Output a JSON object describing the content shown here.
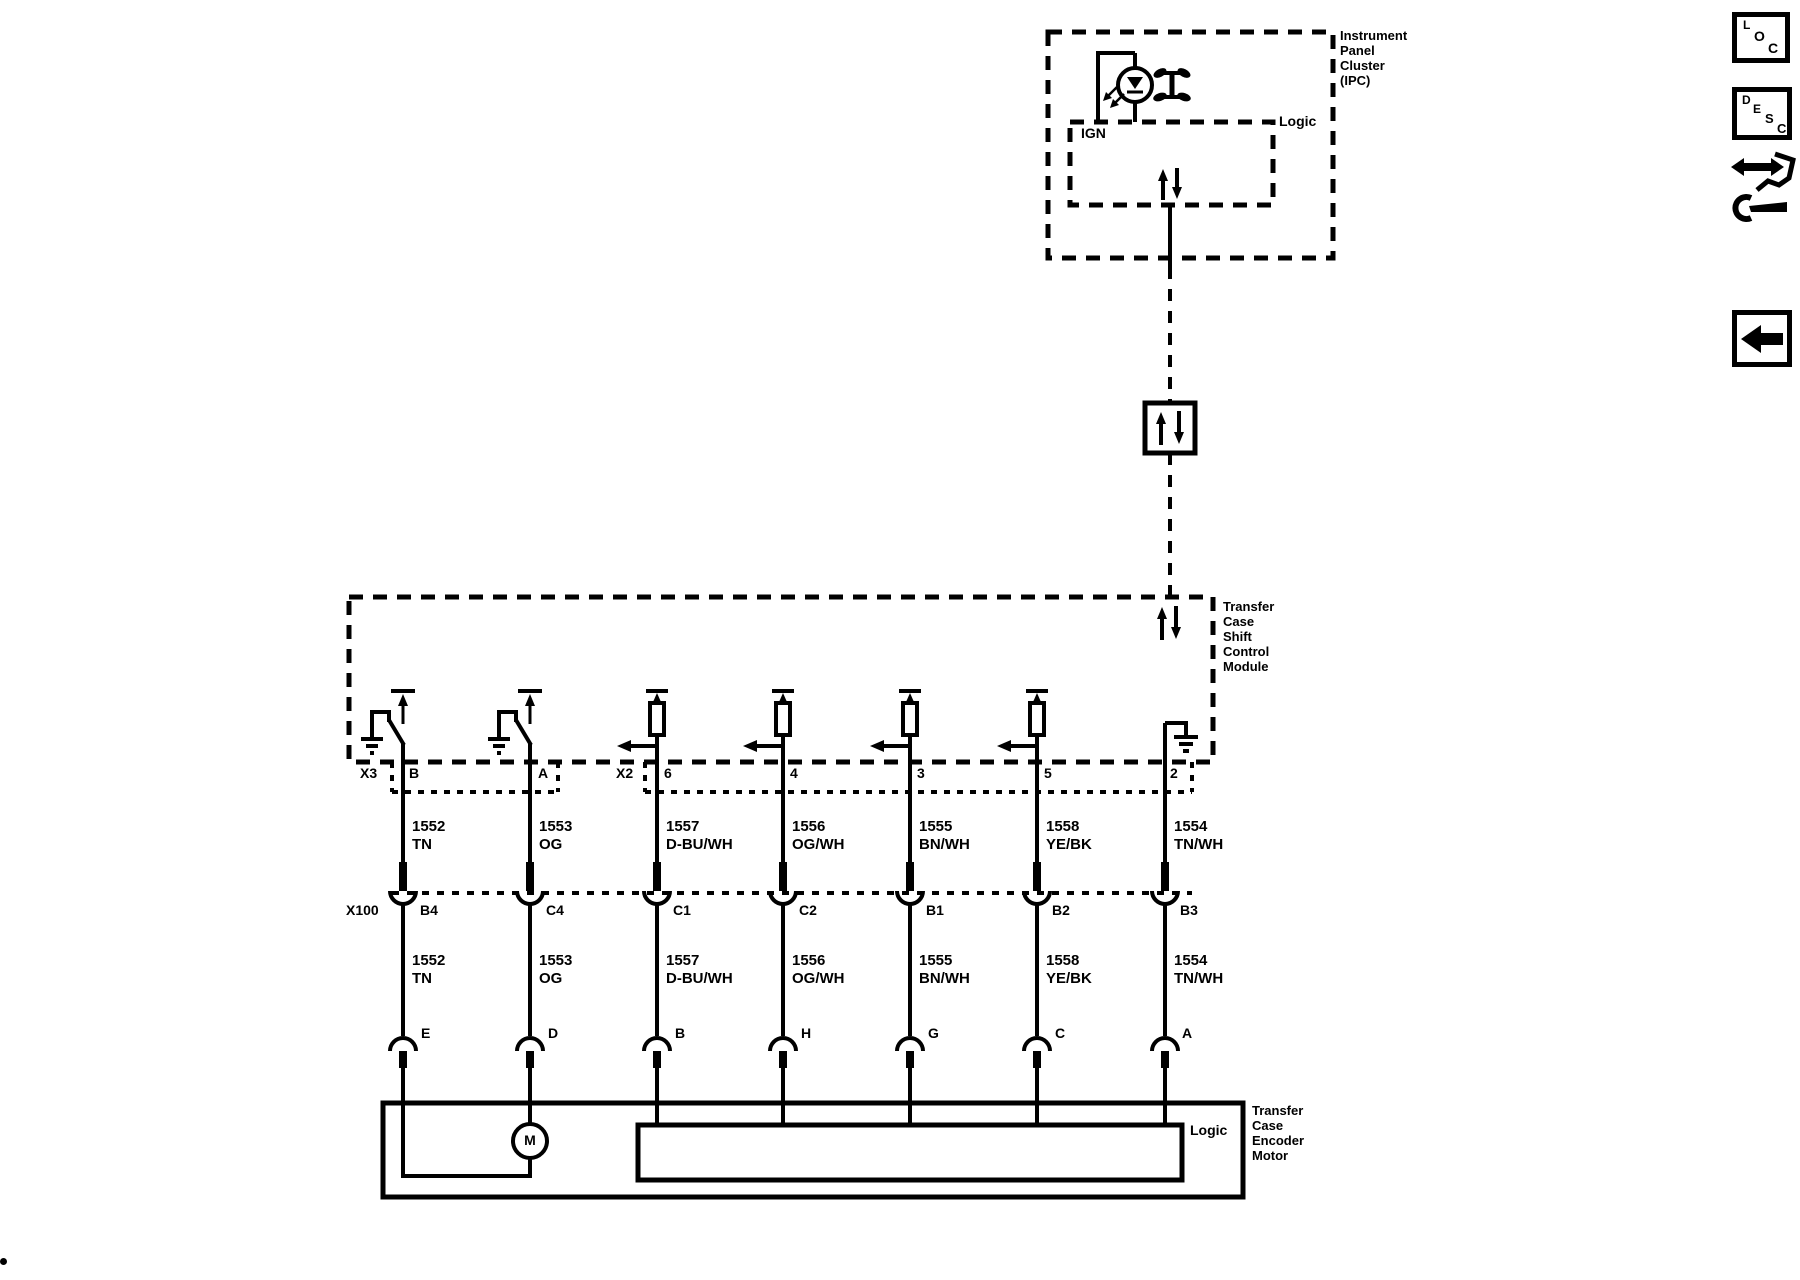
{
  "toolbar": {
    "loc_letters": [
      "L",
      "O",
      "C"
    ],
    "desc_letters": [
      "D",
      "E",
      "S",
      "C"
    ]
  },
  "diagram": {
    "ipc": {
      "name_lines": [
        "Instrument",
        "Panel",
        "Cluster",
        "(IPC)"
      ],
      "logic_label": "Logic",
      "ign_label": "IGN"
    },
    "tccm": {
      "name_lines": [
        "Transfer",
        "Case",
        "Shift",
        "Control",
        "Module"
      ]
    },
    "encoder": {
      "name_lines": [
        "Transfer",
        "Case",
        "Encoder",
        "Motor"
      ],
      "logic_label": "Logic",
      "motor_label": "M"
    },
    "connectors": {
      "x3": {
        "label": "X3",
        "pins": [
          "B",
          "A"
        ]
      },
      "x2": {
        "label": "X2",
        "pins": [
          "6",
          "4",
          "3",
          "5",
          "2"
        ]
      },
      "x100": {
        "label": "X100",
        "pins": [
          "B4",
          "C4",
          "C1",
          "C2",
          "B1",
          "B2",
          "B3"
        ]
      },
      "motor_pins": [
        "E",
        "D",
        "B",
        "H",
        "G",
        "C",
        "A"
      ]
    },
    "wires": [
      {
        "circuit": "1552",
        "color": "TN"
      },
      {
        "circuit": "1553",
        "color": "OG"
      },
      {
        "circuit": "1557",
        "color": "D-BU/WH"
      },
      {
        "circuit": "1556",
        "color": "OG/WH"
      },
      {
        "circuit": "1555",
        "color": "BN/WH"
      },
      {
        "circuit": "1558",
        "color": "YE/BK"
      },
      {
        "circuit": "1554",
        "color": "TN/WH"
      }
    ]
  },
  "colors": {
    "ink": "#000000",
    "background": "#ffffff"
  }
}
